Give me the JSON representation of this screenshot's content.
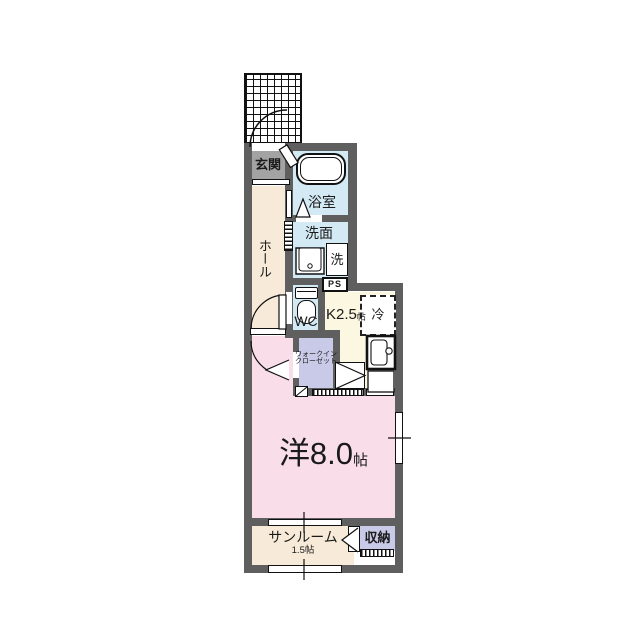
{
  "title": "apartment-floor-plan",
  "colors": {
    "wall": "#5f5f5f",
    "genkan_floor": "#a3a3a3",
    "hall_floor": "#f7ead8",
    "wet_floor": "#d3eaf5",
    "kitchen_floor": "#fbf7e0",
    "closet_floor": "#c9c9e8",
    "main_floor": "#f9dde9",
    "line": "#111111"
  },
  "rooms": {
    "genkan": {
      "label": "玄関"
    },
    "hall": {
      "label": "ホール"
    },
    "bathroom": {
      "label": "浴室"
    },
    "washroom": {
      "label": "洗面"
    },
    "washer": {
      "label": "洗"
    },
    "wc": {
      "label": "WC"
    },
    "ps": {
      "label": "PS"
    },
    "kitchen": {
      "label": "K2.5",
      "unit": "帖"
    },
    "fridge": {
      "label": "冷"
    },
    "wic": {
      "line1": "ウォークイン",
      "line2": "クローゼット"
    },
    "main": {
      "label": "洋8.0",
      "unit": "帖"
    },
    "sunroom": {
      "label": "サンルーム",
      "size": "1.5帖"
    },
    "storage": {
      "label": "収納"
    }
  },
  "icons": [
    "entry-door-arc",
    "hall-door-arc",
    "room-door-arc",
    "bath-door-mark",
    "wic-door-arrow",
    "storage-door-arrow",
    "bathtub",
    "washbasin",
    "toilet",
    "kitchen-sink",
    "refrigerator",
    "window-tick-right",
    "window-tick-sunroom-top",
    "window-tick-sunroom-bottom",
    "counter-hatch",
    "post-mark"
  ]
}
